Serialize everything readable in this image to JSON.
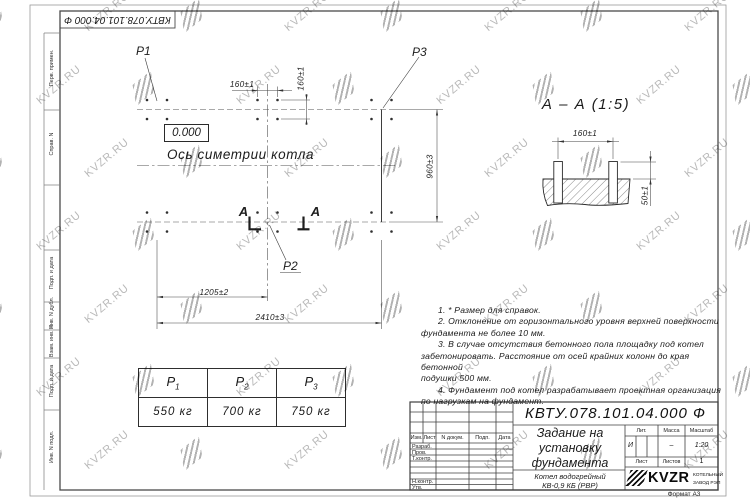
{
  "watermark": {
    "text": "KVZR.RU"
  },
  "frame": {
    "stamp_flipped": "КВТУ.078.101.04.000 Ф",
    "margin_labels": [
      "Перв. примен.",
      "Справ. N",
      "Подп. и дата",
      "Инв. N дубл.",
      "Взам. инв. N",
      "Подп. и дата",
      "Инв. N подл."
    ],
    "format_label": "Формат А3"
  },
  "plan": {
    "load_p1": "P1",
    "load_p2": "P2",
    "load_p3": "P3",
    "elevation": "0.000",
    "axis_label": "Ось симетрии котла",
    "section_letter_left": "А",
    "section_letter_right": "А",
    "dim_top": "160±1",
    "dim_side": "160±1",
    "dim_height": "960±3",
    "dim_half": "1205±2",
    "dim_full": "2410±3"
  },
  "section_view": {
    "title": "А – А (1:5)",
    "dim_spacing": "160±1",
    "dim_protrusion": "50±1"
  },
  "load_table": {
    "headers": [
      {
        "base": "P",
        "sub": "1"
      },
      {
        "base": "P",
        "sub": "2"
      },
      {
        "base": "P",
        "sub": "3"
      }
    ],
    "values": [
      "550 кг",
      "700 кг",
      "750 кг"
    ]
  },
  "notes": {
    "lines": [
      "1.  * Размер для справок.",
      "2.  Отклонение от горизонтального уровня верхней поверхности",
      "фундамента не более 10 мм.",
      "3.  В случае отсутствия бетонного пола площадку под котел",
      "забетонировать. Расстояние от осей крайних колонн до края бетонной",
      "подушки 500 мм.",
      "4.  Фундамент под котел разрабатывает проектная организация",
      "по нагрузкам на фундамент."
    ]
  },
  "title_block": {
    "doc_number": "КВТУ.078.101.04.000  Ф",
    "title_lines": [
      "Задание на",
      "установку",
      "фундамента"
    ],
    "product_lines": [
      "Котел водогрейный",
      "КВ-0,9 КБ  (РВР)"
    ],
    "header_cols": {
      "izm": "Изм.",
      "list": "Лист",
      "doc": "N докум.",
      "podp": "Подп.",
      "data": "Дата"
    },
    "rows": {
      "razrab": "Разраб.",
      "prov": "Пров.",
      "tkontr": "Т.контр.",
      "nkontr": "Н.контр.",
      "utv": "Утв."
    },
    "lit_label": "Лит.",
    "lit_value": "И",
    "mass_label": "Масса",
    "mass_value": "–",
    "scale_label": "Масштаб",
    "scale_value": "1:20",
    "sheet_label": "Лист",
    "sheets_label": "Листов",
    "sheets_value": "1",
    "logo_text": "KVZR",
    "logo_sub_lines": [
      "КОТЕЛЬНЫЙ",
      "ЗАВОД РЭП"
    ]
  }
}
